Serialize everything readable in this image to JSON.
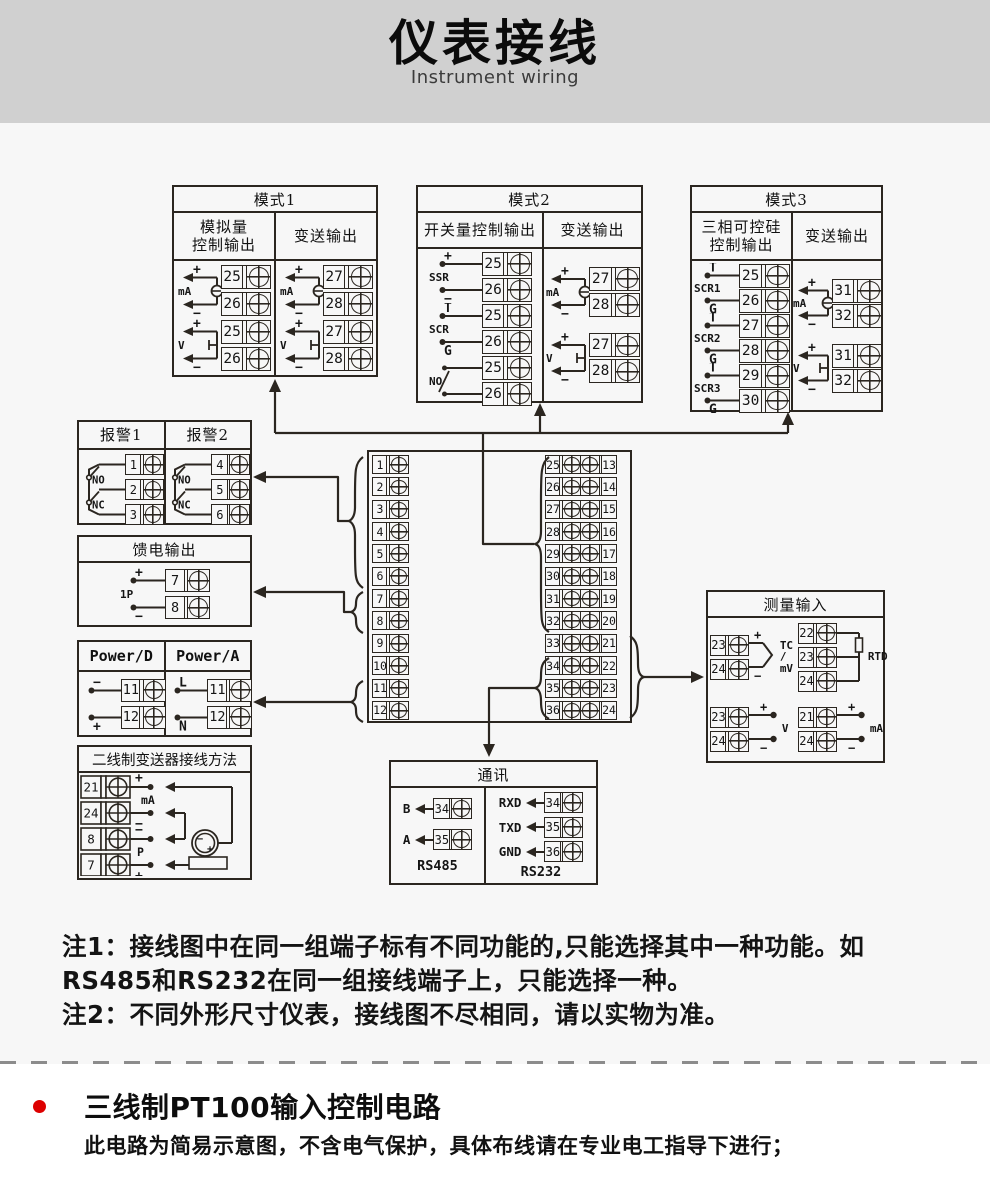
{
  "header": {
    "title": "仪表接线",
    "subtitle": "Instrument wiring"
  },
  "terminal_block": {
    "left": [
      "1",
      "2",
      "3",
      "4",
      "5",
      "6",
      "7",
      "8",
      "9",
      "10",
      "11",
      "12"
    ],
    "mid": [
      "25",
      "26",
      "27",
      "28",
      "29",
      "30",
      "31",
      "32",
      "33",
      "34",
      "35",
      "36"
    ],
    "right": [
      "13",
      "14",
      "15",
      "16",
      "17",
      "18",
      "19",
      "20",
      "21",
      "22",
      "23",
      "24"
    ]
  },
  "boxes": {
    "mode1": {
      "title": "模式1",
      "cols": [
        {
          "header": "模拟量\n控制输出",
          "groups": [
            {
              "label": "mA",
              "kind": "src",
              "pins": [
                {
                  "sign": "+",
                  "num": "25"
                },
                {
                  "sign": "−",
                  "num": "26"
                }
              ]
            },
            {
              "label": "V",
              "kind": "vsrc",
              "pins": [
                {
                  "sign": "+",
                  "num": "25"
                },
                {
                  "sign": "−",
                  "num": "26"
                }
              ]
            }
          ]
        },
        {
          "header": "变送输出",
          "groups": [
            {
              "label": "mA",
              "kind": "src",
              "pins": [
                {
                  "sign": "+",
                  "num": "27"
                },
                {
                  "sign": "−",
                  "num": "28"
                }
              ]
            },
            {
              "label": "V",
              "kind": "vsrc",
              "pins": [
                {
                  "sign": "+",
                  "num": "27"
                },
                {
                  "sign": "−",
                  "num": "28"
                }
              ]
            }
          ]
        }
      ]
    },
    "mode2": {
      "title": "模式2",
      "cols": [
        {
          "header": "开关量控制输出",
          "groups": [
            {
              "label": "SSR",
              "kind": "dot",
              "pins": [
                {
                  "sign": "+",
                  "num": "25"
                },
                {
                  "sign": "−",
                  "num": "26"
                }
              ]
            },
            {
              "label": "SCR",
              "kind": "dot",
              "pins": [
                {
                  "sign": "T",
                  "num": "25"
                },
                {
                  "sign": "G",
                  "num": "26"
                }
              ]
            },
            {
              "label": "NO",
              "kind": "sw",
              "pins": [
                {
                  "num": "25"
                },
                {
                  "num": "26"
                }
              ]
            }
          ]
        },
        {
          "header": "变送输出",
          "groups": [
            {
              "label": "mA",
              "kind": "src",
              "pins": [
                {
                  "sign": "+",
                  "num": "27"
                },
                {
                  "sign": "−",
                  "num": "28"
                }
              ]
            },
            {
              "label": "V",
              "kind": "vsrc",
              "pins": [
                {
                  "sign": "+",
                  "num": "27"
                },
                {
                  "sign": "−",
                  "num": "28"
                }
              ]
            }
          ]
        }
      ]
    },
    "mode3": {
      "title": "模式3",
      "cols": [
        {
          "header": "三相可控硅\n控制输出",
          "groups": [
            {
              "label": "SCR1",
              "kind": "dot",
              "pins": [
                {
                  "sign": "T",
                  "num": "25"
                },
                {
                  "sign": "G",
                  "num": "26"
                }
              ]
            },
            {
              "label": "SCR2",
              "kind": "dot",
              "pins": [
                {
                  "sign": "T",
                  "num": "27"
                },
                {
                  "sign": "G",
                  "num": "28"
                }
              ]
            },
            {
              "label": "SCR3",
              "kind": "dot",
              "pins": [
                {
                  "sign": "T",
                  "num": "29"
                },
                {
                  "sign": "G",
                  "num": "30"
                }
              ]
            }
          ]
        },
        {
          "header": "变送输出",
          "groups": [
            {
              "label": "mA",
              "kind": "src",
              "pins": [
                {
                  "sign": "+",
                  "num": "31"
                },
                {
                  "sign": "−",
                  "num": "32"
                }
              ]
            },
            {
              "label": "V",
              "kind": "vsrc",
              "pins": [
                {
                  "sign": "+",
                  "num": "31"
                },
                {
                  "sign": "−",
                  "num": "32"
                }
              ]
            }
          ]
        }
      ]
    },
    "alarm": {
      "cols": [
        {
          "header": "报警1",
          "groups": [
            {
              "kind": "alarm",
              "sw1": "NO",
              "sw2": "NC",
              "pins": [
                {
                  "num": "1"
                },
                {
                  "num": "2"
                },
                {
                  "num": "3"
                }
              ]
            }
          ]
        },
        {
          "header": "报警2",
          "groups": [
            {
              "kind": "alarm",
              "sw1": "NO",
              "sw2": "NC",
              "pins": [
                {
                  "num": "4"
                },
                {
                  "num": "5"
                },
                {
                  "num": "6"
                }
              ]
            }
          ]
        }
      ]
    },
    "feed": {
      "title": "馈电输出",
      "cols": [
        {
          "groups": [
            {
              "label": "1P",
              "kind": "dot",
              "pins": [
                {
                  "sign": "+",
                  "num": "7"
                },
                {
                  "sign": "−",
                  "num": "8"
                }
              ]
            }
          ]
        }
      ]
    },
    "power": {
      "cols": [
        {
          "header": "Power/D",
          "groups": [
            {
              "kind": "dot",
              "pins": [
                {
                  "sign": "−",
                  "num": "11"
                },
                {
                  "sign": "+",
                  "num": "12"
                }
              ]
            }
          ]
        },
        {
          "header": "Power/A",
          "groups": [
            {
              "kind": "dot",
              "pins": [
                {
                  "sign": "L",
                  "num": "11"
                },
                {
                  "sign": "N",
                  "num": "12"
                }
              ]
            }
          ]
        }
      ]
    },
    "twowire": {
      "title": "二线制变送器接线方法",
      "rows": [
        {
          "num": "21",
          "sign": "+"
        },
        {
          "num": "24",
          "sign": "−"
        },
        {
          "num": "8",
          "sign": "−"
        },
        {
          "num": "7",
          "sign": "+"
        }
      ],
      "labels": {
        "top": "mA",
        "bottom": "P"
      },
      "transmitter": {
        "minus": "−",
        "plus": "+"
      }
    },
    "comm": {
      "title": "通讯",
      "cols": [
        {
          "caption": "RS485",
          "rows": [
            {
              "label": "B",
              "num": "34"
            },
            {
              "label": "A",
              "num": "35"
            }
          ]
        },
        {
          "caption": "RS232",
          "rows": [
            {
              "label": "RXD",
              "num": "34"
            },
            {
              "label": "TXD",
              "num": "35"
            },
            {
              "label": "GND",
              "num": "36"
            }
          ]
        }
      ]
    },
    "measure": {
      "title": "测量输入",
      "groups": [
        {
          "kind": "tc",
          "label": "TC\n/\nmV",
          "pins": [
            {
              "sign": "+",
              "num": "23"
            },
            {
              "sign": "−",
              "num": "24"
            }
          ]
        },
        {
          "kind": "rtd",
          "label": "RTD",
          "pins": [
            {
              "num": "22"
            },
            {
              "num": "23"
            },
            {
              "num": "24"
            }
          ]
        },
        {
          "kind": "vdot",
          "label": "V",
          "pins": [
            {
              "sign": "+",
              "num": "23"
            },
            {
              "sign": "−",
              "num": "24"
            }
          ]
        },
        {
          "kind": "vdot",
          "label": "mA",
          "pins": [
            {
              "sign": "+",
              "num": "21"
            },
            {
              "sign": "−",
              "num": "24"
            }
          ]
        }
      ]
    }
  },
  "notes": {
    "line1": "注1：接线图中在同一组端子标有不同功能的,只能选择其中一种功能。如",
    "line2": "RS485和RS232在同一组接线端子上，只能选择一种。",
    "line3": "注2：不同外形尺寸仪表，接线图不尽相同，请以实物为准。"
  },
  "bottom": {
    "title": "三线制PT100输入控制电路",
    "desc": "此电路为简易示意图，不含电气保护，具体布线请在专业电工指导下进行；"
  },
  "colors": {
    "line": "#2b2620",
    "accent_red": "#dd0000",
    "header_bg": "#d0d0d0",
    "diagram_bg": "#f7f7f7"
  }
}
